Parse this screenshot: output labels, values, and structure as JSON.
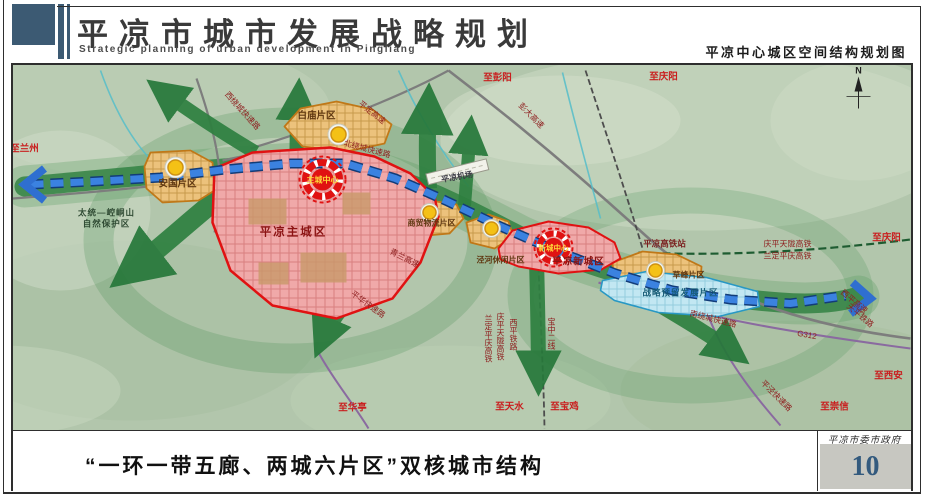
{
  "header": {
    "title_cn": "平凉市城市发展战略规划",
    "title_en": "Strategic planning of urban development in Pingliang",
    "subtitle_right": "平凉中心城区空间结构规划图"
  },
  "footer": {
    "caption": "“一环一带五廊、两城六片区”双核城市结构",
    "agency": "平凉市委市政府",
    "page_number": "10"
  },
  "map": {
    "north_label": "N",
    "colors": {
      "accent_slate": "#3c5a73",
      "terrain": "#b2c6ac",
      "corridor_green": "#2e8040",
      "axis_blue": "#3b82e0",
      "core_red": "#e01212",
      "district_orange": "#ecc27c",
      "reserve_blue": "#c2e7f2",
      "node_yellow": "#f4c116"
    },
    "labels": [
      {
        "id": "to-lanzhou",
        "text": "至兰州",
        "x": 24,
        "y": 151,
        "cls": "dest"
      },
      {
        "id": "to-pengyang",
        "text": "至彭阳",
        "x": 497,
        "y": 80,
        "cls": "dest"
      },
      {
        "id": "to-qingyang-north",
        "text": "至庆阳",
        "x": 663,
        "y": 79,
        "cls": "dest"
      },
      {
        "id": "to-qingyang-east",
        "text": "至庆阳",
        "x": 886,
        "y": 240,
        "cls": "dest"
      },
      {
        "id": "to-xian",
        "text": "至西安",
        "x": 888,
        "y": 378,
        "cls": "dest"
      },
      {
        "id": "to-chongxin",
        "text": "至崇信",
        "x": 834,
        "y": 409,
        "cls": "dest"
      },
      {
        "id": "to-huating",
        "text": "至华亭",
        "x": 352,
        "y": 410,
        "cls": "dest"
      },
      {
        "id": "to-tianshui",
        "text": "至天水",
        "x": 509,
        "y": 409,
        "cls": "dest"
      },
      {
        "id": "to-baoji",
        "text": "至宝鸡",
        "x": 564,
        "y": 409,
        "cls": "dest"
      },
      {
        "id": "west-ring-expressway",
        "text": "西绕城快速路",
        "x": 240,
        "y": 112,
        "cls": "road",
        "rot": 48
      },
      {
        "id": "north-ring-expressway",
        "text": "北绕城快速路",
        "x": 366,
        "y": 151,
        "cls": "road",
        "rot": 15
      },
      {
        "id": "pingding-expressway",
        "text": "平定高速",
        "x": 370,
        "y": 114,
        "cls": "road",
        "rot": 38
      },
      {
        "id": "pengda-expressway",
        "text": "彭大高速",
        "x": 529,
        "y": 117,
        "cls": "road",
        "rot": 45
      },
      {
        "id": "qinglan-expressway",
        "text": "青兰高速",
        "x": 403,
        "y": 260,
        "cls": "road",
        "rot": 27
      },
      {
        "id": "pinghua-expressway",
        "text": "平华快速路",
        "x": 366,
        "y": 306,
        "cls": "road",
        "rot": 36
      },
      {
        "id": "south-ring-expressway",
        "text": "南绕城快速路",
        "x": 712,
        "y": 321,
        "cls": "road",
        "rot": 14
      },
      {
        "id": "pingjing-expressway",
        "text": "平泾快速路",
        "x": 774,
        "y": 397,
        "cls": "road",
        "rot": 45
      },
      {
        "id": "g312",
        "text": "G312",
        "x": 806,
        "y": 337,
        "cls": "road",
        "rot": 10
      },
      {
        "id": "qingping-tianlong-hsr",
        "text": "庆平天陇高铁",
        "x": 787,
        "y": 246,
        "cls": "rail"
      },
      {
        "id": "landing-pingqing-hsr",
        "text": "兰定平庆高铁",
        "x": 787,
        "y": 258,
        "cls": "rail"
      },
      {
        "id": "pingliang-hsr-station",
        "text": "平凉高铁站",
        "x": 664,
        "y": 246,
        "cls": "station"
      },
      {
        "id": "baozhong-line-2",
        "text": "宝中二线",
        "x": 551,
        "y": 317,
        "cls": "rail",
        "vert": true
      },
      {
        "id": "xiping-railway",
        "text": "西平铁路",
        "x": 513,
        "y": 318,
        "cls": "rail",
        "vert": true
      },
      {
        "id": "qingping-tianlong-hsr-south",
        "text": "庆平天陇高铁",
        "x": 500,
        "y": 312,
        "cls": "rail",
        "vert": true
      },
      {
        "id": "landing-pingqing-hsr-south",
        "text": "兰定平庆高铁",
        "x": 488,
        "y": 314,
        "cls": "rail",
        "vert": true
      },
      {
        "id": "xiping-expressway",
        "text": "西平高速",
        "x": 852,
        "y": 303,
        "cls": "rail",
        "rot": 40
      },
      {
        "id": "tianping-railway",
        "text": "天平铁路",
        "x": 858,
        "y": 317,
        "cls": "rail",
        "rot": 40
      },
      {
        "id": "anguo-district",
        "text": "安国片区",
        "x": 177,
        "y": 186,
        "cls": "zone"
      },
      {
        "id": "baimiao-district",
        "text": "白庙片区",
        "x": 316,
        "y": 118,
        "cls": "zone"
      },
      {
        "id": "trade-logistics-district",
        "text": "商贸物流片区",
        "x": 431,
        "y": 225,
        "cls": "zone-sm"
      },
      {
        "id": "jinghe-leisure-district",
        "text": "泾河休闲片区",
        "x": 500,
        "y": 262,
        "cls": "zone-sm"
      },
      {
        "id": "caofeng-district",
        "text": "草峰片区",
        "x": 688,
        "y": 277,
        "cls": "zone-sm"
      },
      {
        "id": "strategic-reserve-district",
        "text": "战略预留发展片区",
        "x": 680,
        "y": 295,
        "cls": "reserve"
      },
      {
        "id": "pingliang-main-city",
        "text": "平凉主城区",
        "x": 293,
        "y": 235,
        "cls": "city"
      },
      {
        "id": "pingliang-new-city",
        "text": "平凉新城区",
        "x": 578,
        "y": 264,
        "cls": "city-sm"
      },
      {
        "id": "main-city-center",
        "text": "主城中心",
        "x": 322,
        "y": 182,
        "cls": "center"
      },
      {
        "id": "new-city-center",
        "text": "新城中心",
        "x": 553,
        "y": 250,
        "cls": "center-sm"
      },
      {
        "id": "pingliang-airport",
        "text": "平凉机场",
        "x": 457,
        "y": 179,
        "cls": "airport",
        "rot": -10
      },
      {
        "id": "nature-reserve-line1",
        "text": "太统—崆峒山",
        "x": 106,
        "y": 215,
        "cls": "nature"
      },
      {
        "id": "nature-reserve-line2",
        "text": "自然保护区",
        "x": 106,
        "y": 226,
        "cls": "nature"
      }
    ]
  }
}
